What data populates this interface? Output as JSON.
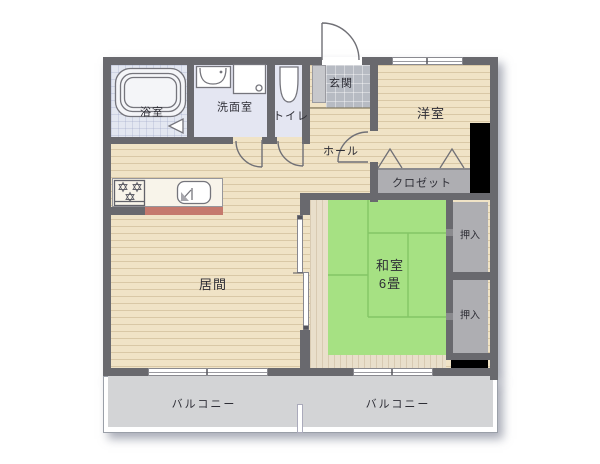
{
  "floorplan": {
    "rooms": {
      "bathroom": {
        "label": "浴室"
      },
      "washroom": {
        "label": "洗面室"
      },
      "toilet": {
        "label": "トイレ"
      },
      "entrance": {
        "label": "玄関"
      },
      "hall": {
        "label": "ホール"
      },
      "western_room": {
        "label": "洋室"
      },
      "closet": {
        "label": "クロゼット"
      },
      "living_room": {
        "label": "居間"
      },
      "japanese_room": {
        "label": "和室",
        "size": "6畳"
      },
      "oshiire_upper": {
        "label": "押入"
      },
      "oshiire_lower": {
        "label": "押入"
      },
      "balcony_left": {
        "label": "バルコニー"
      },
      "balcony_right": {
        "label": "バルコニー"
      }
    },
    "colors": {
      "wall": "#69696e",
      "wood_floor": "#f0e3c6",
      "tatami": "#a6e183",
      "tatami_line": "#84c566",
      "closet_floor": "#aeaeb2",
      "entrance_tile": "#b7bbc3",
      "bath_tile": "#e3e7f1",
      "wet_room_floor": "#e4e6f2",
      "balcony_floor": "#d3d4d6",
      "counter_face": "#c5796d",
      "pipe_space": "#000000",
      "background": "#ffffff"
    },
    "icons": [
      "bathtub-icon",
      "washbasin-icon",
      "washing-machine-pan-icon",
      "toilet-bowl-icon",
      "stove-icon",
      "sink-icon",
      "door-swing-icon",
      "folding-door-icon",
      "sliding-door-icon",
      "window-icon"
    ]
  }
}
